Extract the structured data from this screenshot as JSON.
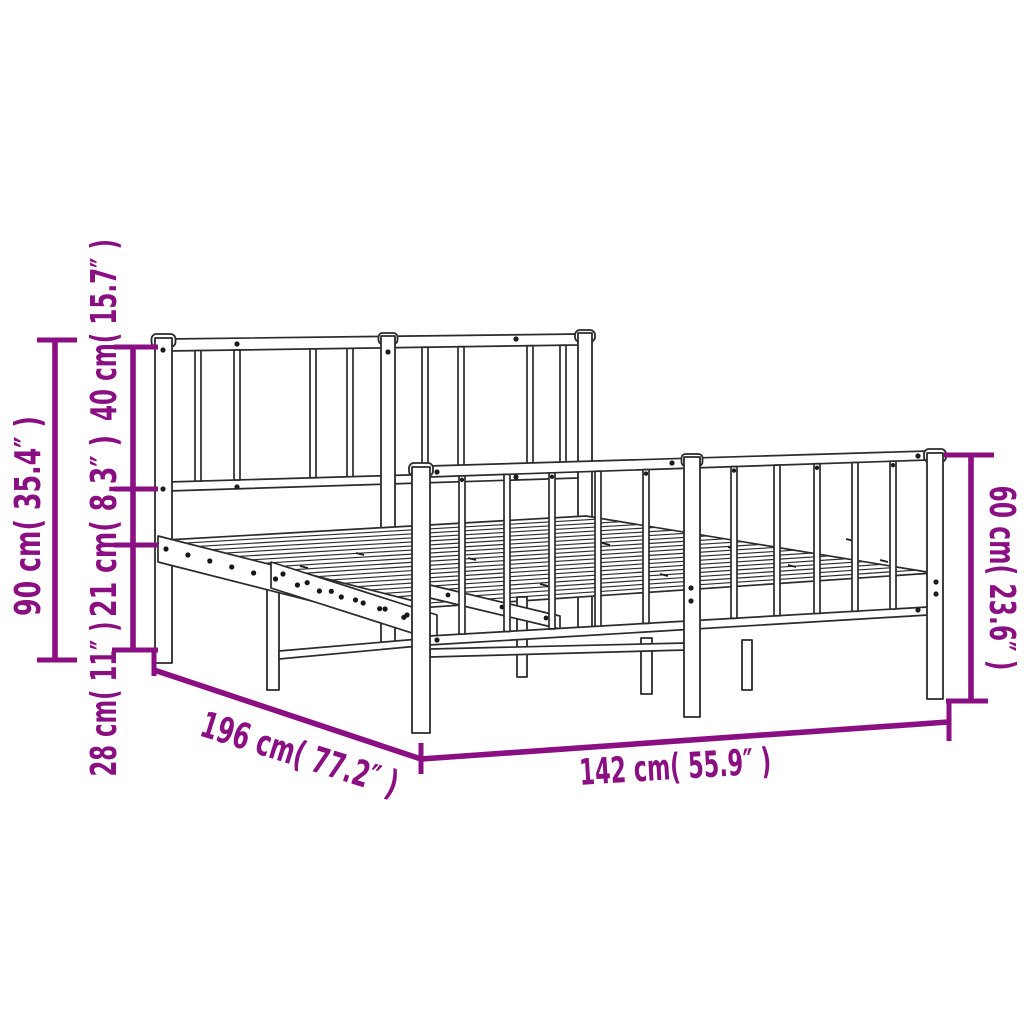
{
  "diagram": {
    "type": "product-dimension-diagram",
    "subject": "metal bed frame with headboard and footboard",
    "background_color": "#ffffff",
    "dimension_color": "#8A0F82",
    "drawing_outline_color": "#2b2b2b",
    "measurements": {
      "overall_height": {
        "value_cm": "90",
        "value_in": "35.4",
        "label": "90 cm( 35.4″ )"
      },
      "headboard_panel_height": {
        "value_cm": "40",
        "value_in": "15.7",
        "label": "40 cm( 15.7″ )"
      },
      "side_rail_height": {
        "value_cm": "21",
        "value_in": "8.3",
        "label": "21 cm( 8.3″ )"
      },
      "under_bed_clearance": {
        "value_cm": "28",
        "value_in": "11",
        "label": "28 cm( 11″ )"
      },
      "bed_length": {
        "value_cm": "196",
        "value_in": "77.2",
        "label": "196 cm( 77.2″ )"
      },
      "bed_width": {
        "value_cm": "142",
        "value_in": "55.9",
        "label": "142 cm( 55.9″ )"
      },
      "footboard_height": {
        "value_cm": "60",
        "value_in": "23.6",
        "label": "60 cm( 23.6″ )"
      }
    }
  }
}
